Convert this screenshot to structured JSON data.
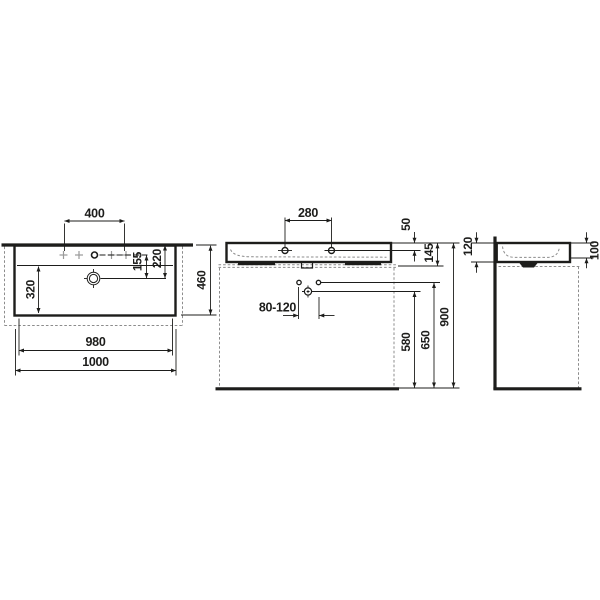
{
  "meta": {
    "background_color": "#ffffff",
    "line_color": "#1d1d1b",
    "dashed_line_color": "#8c8c8c",
    "drawing_type": "washbasin dimensional technical drawing"
  },
  "views": {
    "front": {
      "label": "front-view",
      "dims": {
        "tap_hole_spacing": "400",
        "bowl_inner_height": "320",
        "tap_line_to_drain": "155",
        "rim_to_drain": "220",
        "overall_depth": "460",
        "inner_width": "980",
        "overall_width": "1000"
      }
    },
    "side": {
      "label": "side-section-view",
      "dims": {
        "anchor_spacing": "280",
        "rim_to_anchor": "50",
        "rim_to_underside": "145",
        "trap_offset_range": "80-120",
        "trap_height": "580",
        "fixing_height": "650",
        "rim_height": "900"
      }
    },
    "profile": {
      "label": "wall-profile-view",
      "dims": {
        "body_height": "120",
        "bowl_depth": "100"
      }
    }
  }
}
